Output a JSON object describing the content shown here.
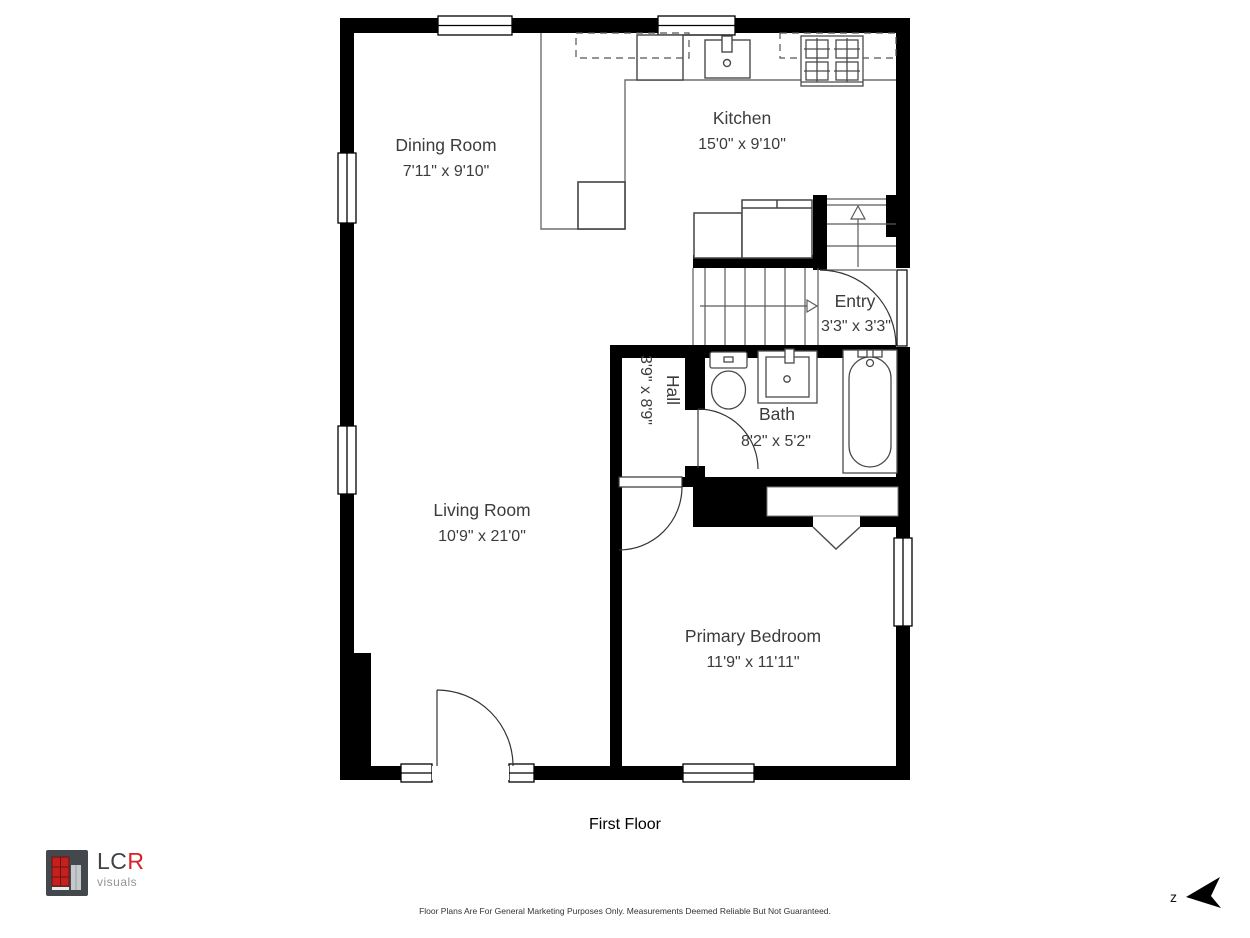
{
  "floor_plan": {
    "floor_label": "First Floor",
    "rooms": [
      {
        "name": "Dining Room",
        "dimensions": "7'11\" x 9'10\""
      },
      {
        "name": "Kitchen",
        "dimensions": "15'0\" x 9'10\""
      },
      {
        "name": "Entry",
        "dimensions": "3'3\" x 3'3\""
      },
      {
        "name": "Hall",
        "dimensions": "3'9\" x 8'9\""
      },
      {
        "name": "Bath",
        "dimensions": "8'2\" x 5'2\""
      },
      {
        "name": "Living Room",
        "dimensions": "10'9\" x 21'0\""
      },
      {
        "name": "Primary Bedroom",
        "dimensions": "11'9\" x 11'11\""
      }
    ],
    "compass_label": "z",
    "wall_color": "#000000",
    "fixture_line_color": "#4a4a4a"
  },
  "branding": {
    "logo_lc": "LC",
    "logo_r": "R",
    "logo_sub": "visuals",
    "accent_red": "#da2128"
  },
  "footer": {
    "disclaimer": "Floor Plans Are For General Marketing Purposes Only. Measurements Deemed Reliable But Not Guaranteed."
  }
}
